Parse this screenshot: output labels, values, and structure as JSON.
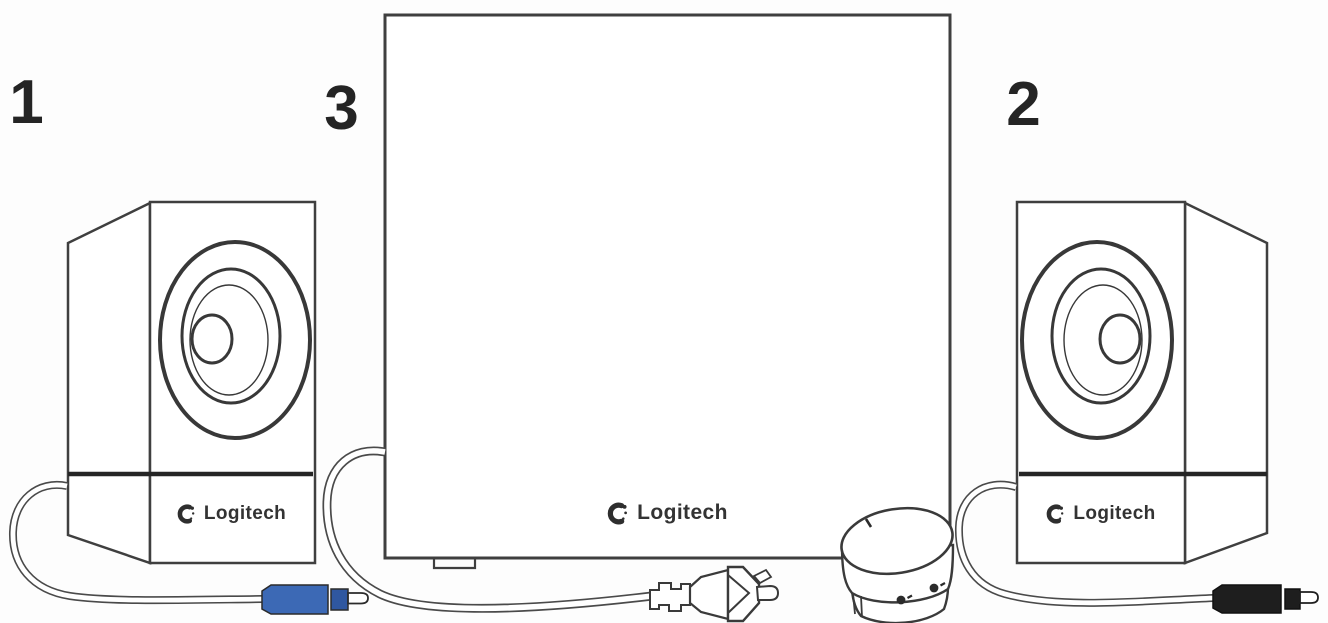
{
  "diagram": {
    "description": "Logitech 2.1 speaker system setup illustration with numbered parts",
    "brand": "Logitech",
    "parts": {
      "left_speaker": {
        "label": "1"
      },
      "right_speaker": {
        "label": "2"
      },
      "subwoofer": {
        "label": "3"
      }
    },
    "colors": {
      "line": "#3f3f3f",
      "divider": "#252525",
      "blue_rca": "#3c69b5",
      "blue_rca_dark": "#2f57a0",
      "black_rca": "#1e1e1e",
      "background": "#fdfdfd"
    }
  }
}
